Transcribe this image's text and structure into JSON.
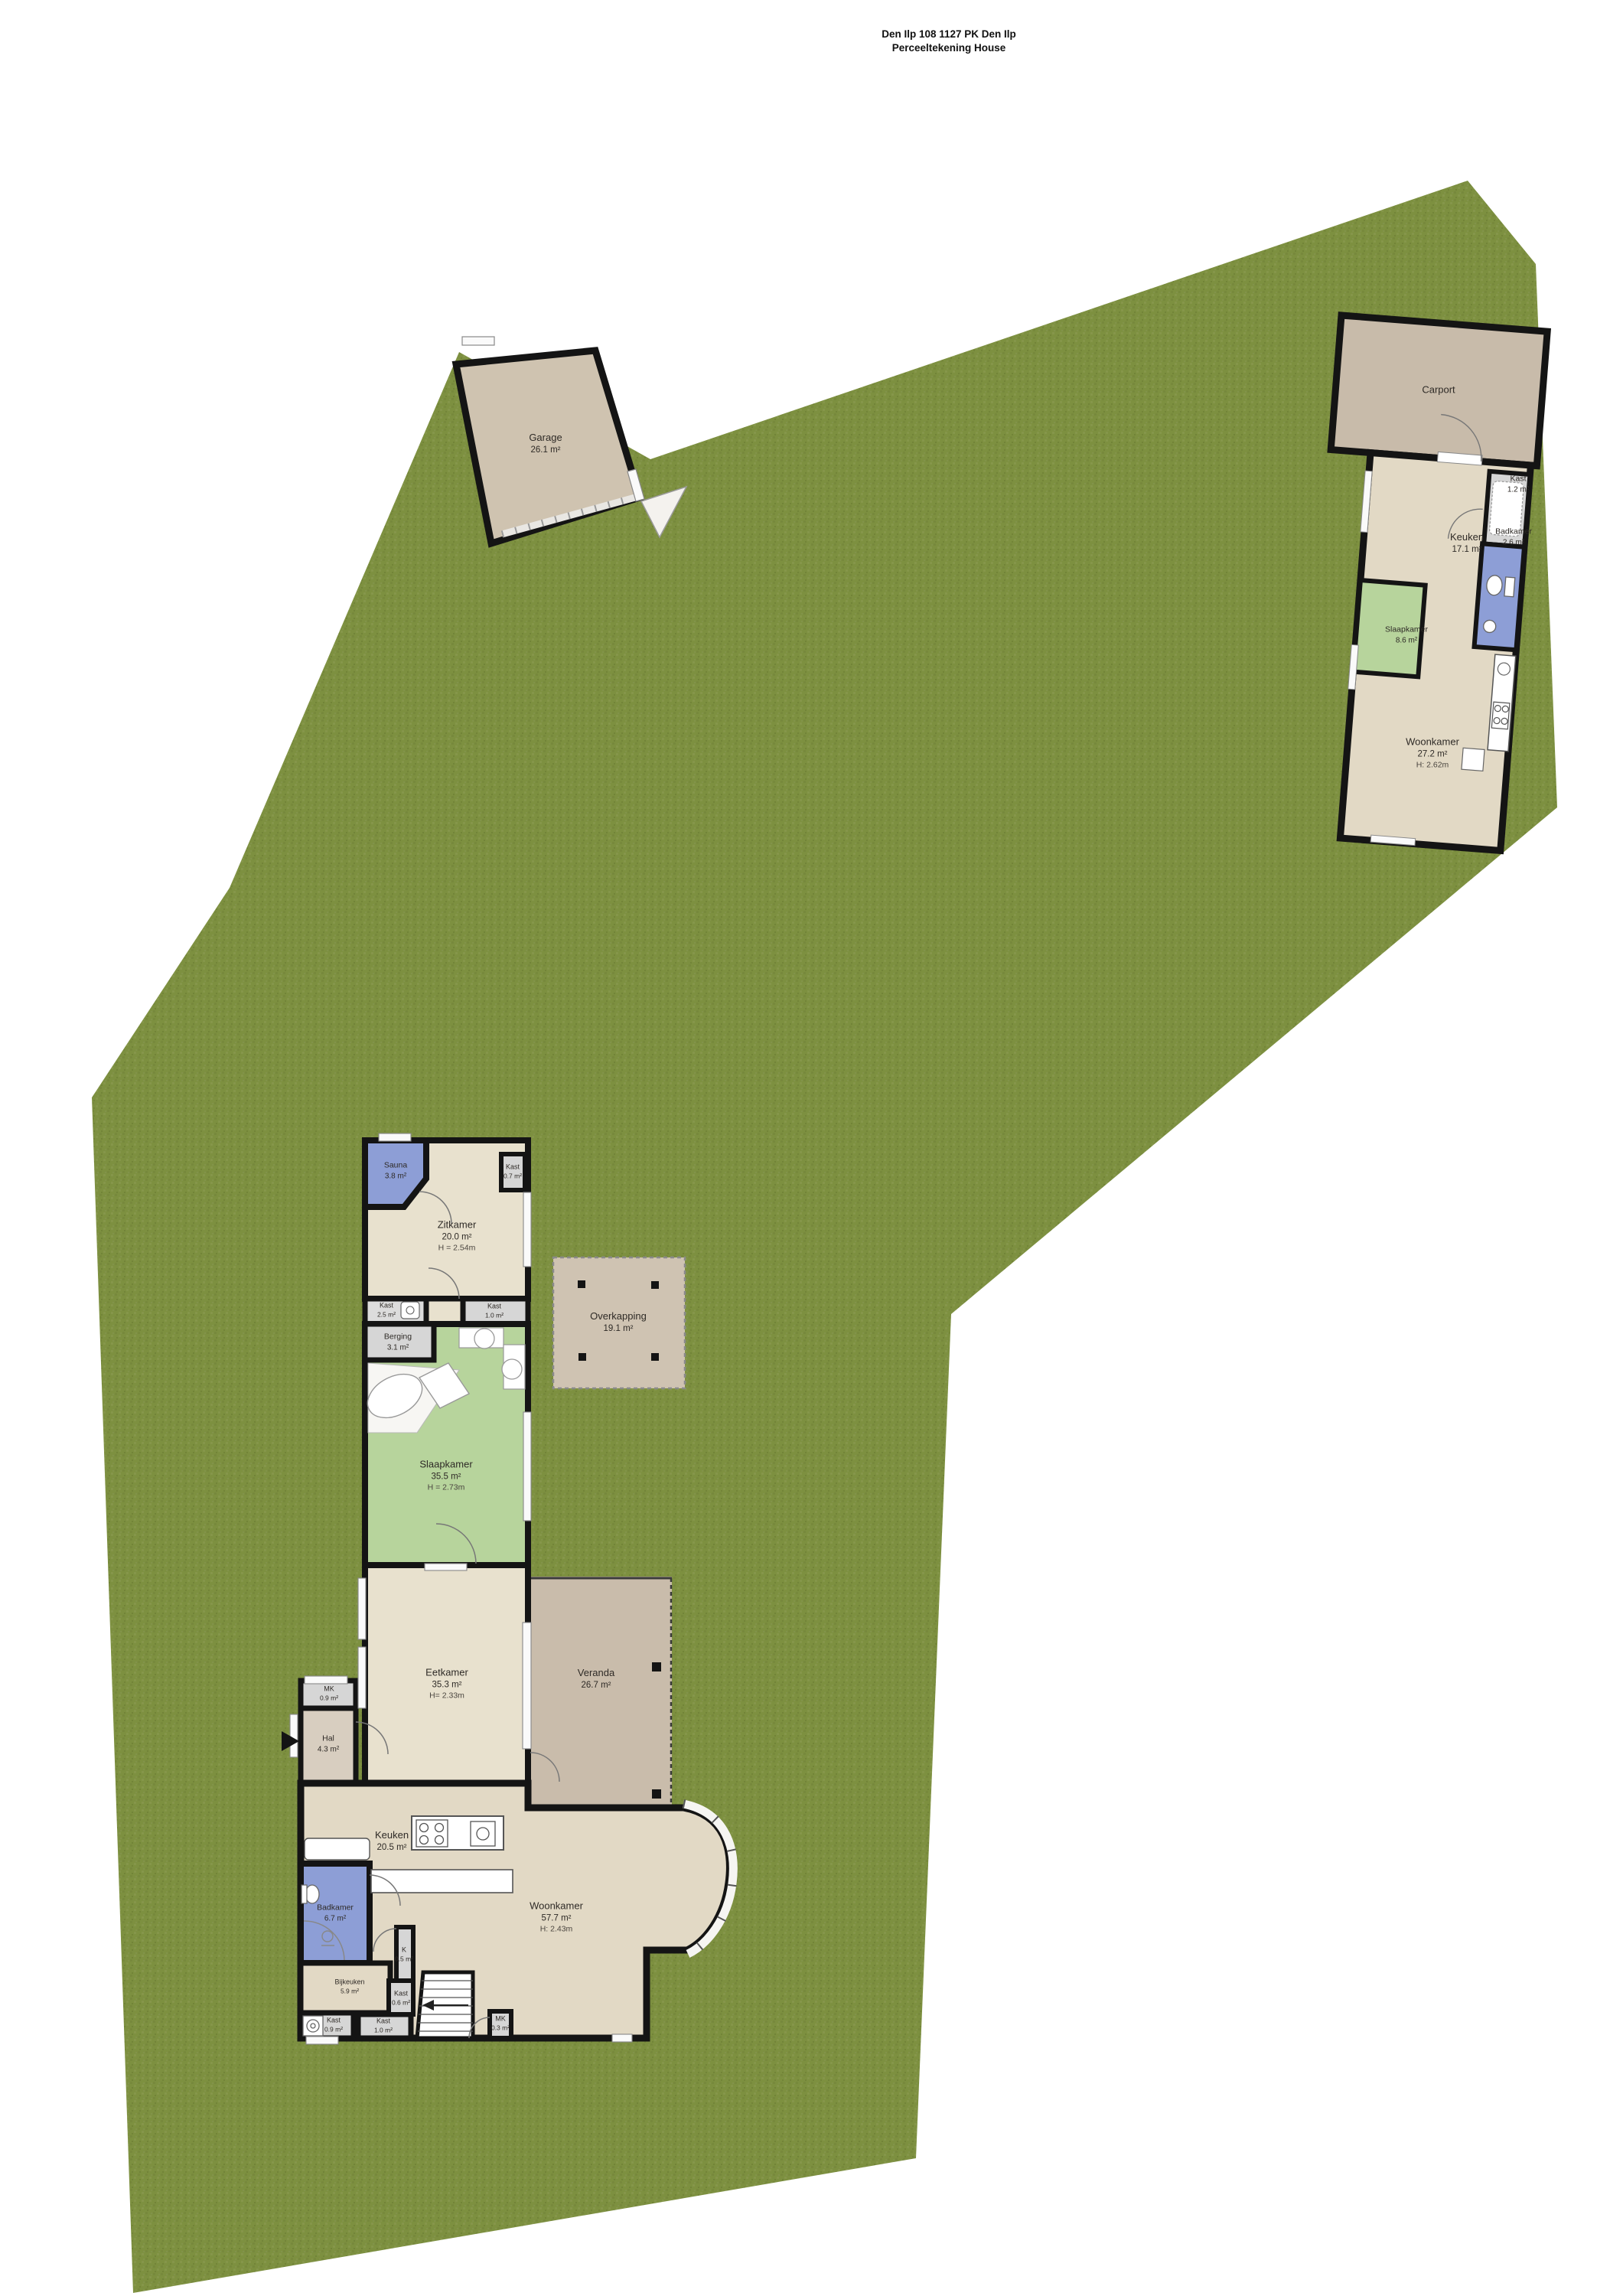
{
  "title": {
    "line1": "Den Ilp 108 1127 PK Den Ilp",
    "line2": "Perceeltekening House"
  },
  "colors": {
    "grass": "#7d9040",
    "walls": "#141414",
    "floor_beige": "#e8e1ce",
    "floor_beige_dark": "#e2d9c5",
    "floor_tan": "#c9bcab",
    "floor_blue": "#8d9ed6",
    "floor_green": "#b7d49c",
    "floor_gray": "#d6d6d6",
    "floor_hal": "#d8cec0"
  },
  "garage": {
    "name": "Garage",
    "area": "26.1 m²"
  },
  "overkapping": {
    "name": "Overkapping",
    "area": "19.1 m²"
  },
  "guest_house": {
    "carport_label": "Carport",
    "rooms": [
      {
        "name": "Keuken",
        "area": "17.1 m²"
      },
      {
        "name": "Kast",
        "area": "1.2 m²"
      },
      {
        "name": "Badkamer",
        "area": "2.6 m²"
      },
      {
        "name": "Slaapkamer",
        "area": "8.6 m²"
      },
      {
        "name": "Woonkamer",
        "area": "27.2 m²",
        "height": "H: 2.62m"
      }
    ]
  },
  "main_house": {
    "rooms": [
      {
        "name": "Sauna",
        "area": "3.8 m²"
      },
      {
        "name": "Zitkamer",
        "area": "20.0 m²",
        "height": "H = 2.54m"
      },
      {
        "name": "Kast",
        "area": "0.7 m²"
      },
      {
        "name": "Kast",
        "area": "2.5 m²"
      },
      {
        "name": "Kast",
        "area": "1.0 m²"
      },
      {
        "name": "Berging",
        "area": "3.1 m²"
      },
      {
        "name": "Slaapkamer",
        "area": "35.5 m²",
        "height": "H = 2.73m"
      },
      {
        "name": "Eetkamer",
        "area": "35.3 m²",
        "height": "H= 2.33m"
      },
      {
        "name": "Veranda",
        "area": "26.7 m²"
      },
      {
        "name": "MK",
        "area": "0.9 m²"
      },
      {
        "name": "Hal",
        "area": "4.3 m²"
      },
      {
        "name": "Keuken",
        "area": "20.5 m²"
      },
      {
        "name": "Woonkamer",
        "area": "57.7 m²",
        "height": "H: 2.43m"
      },
      {
        "name": "Badkamer",
        "area": "6.7 m²"
      },
      {
        "name": "K",
        "area": "0.5 m²"
      },
      {
        "name": "Kast",
        "area": "0.6 m²"
      },
      {
        "name": "Bijkeuken",
        "area": "5.9 m²"
      },
      {
        "name": "Kast",
        "area": "0.9 m²"
      },
      {
        "name": "Kast",
        "area": "1.0 m²"
      },
      {
        "name": "MK",
        "area": "0.3 m²"
      }
    ]
  }
}
